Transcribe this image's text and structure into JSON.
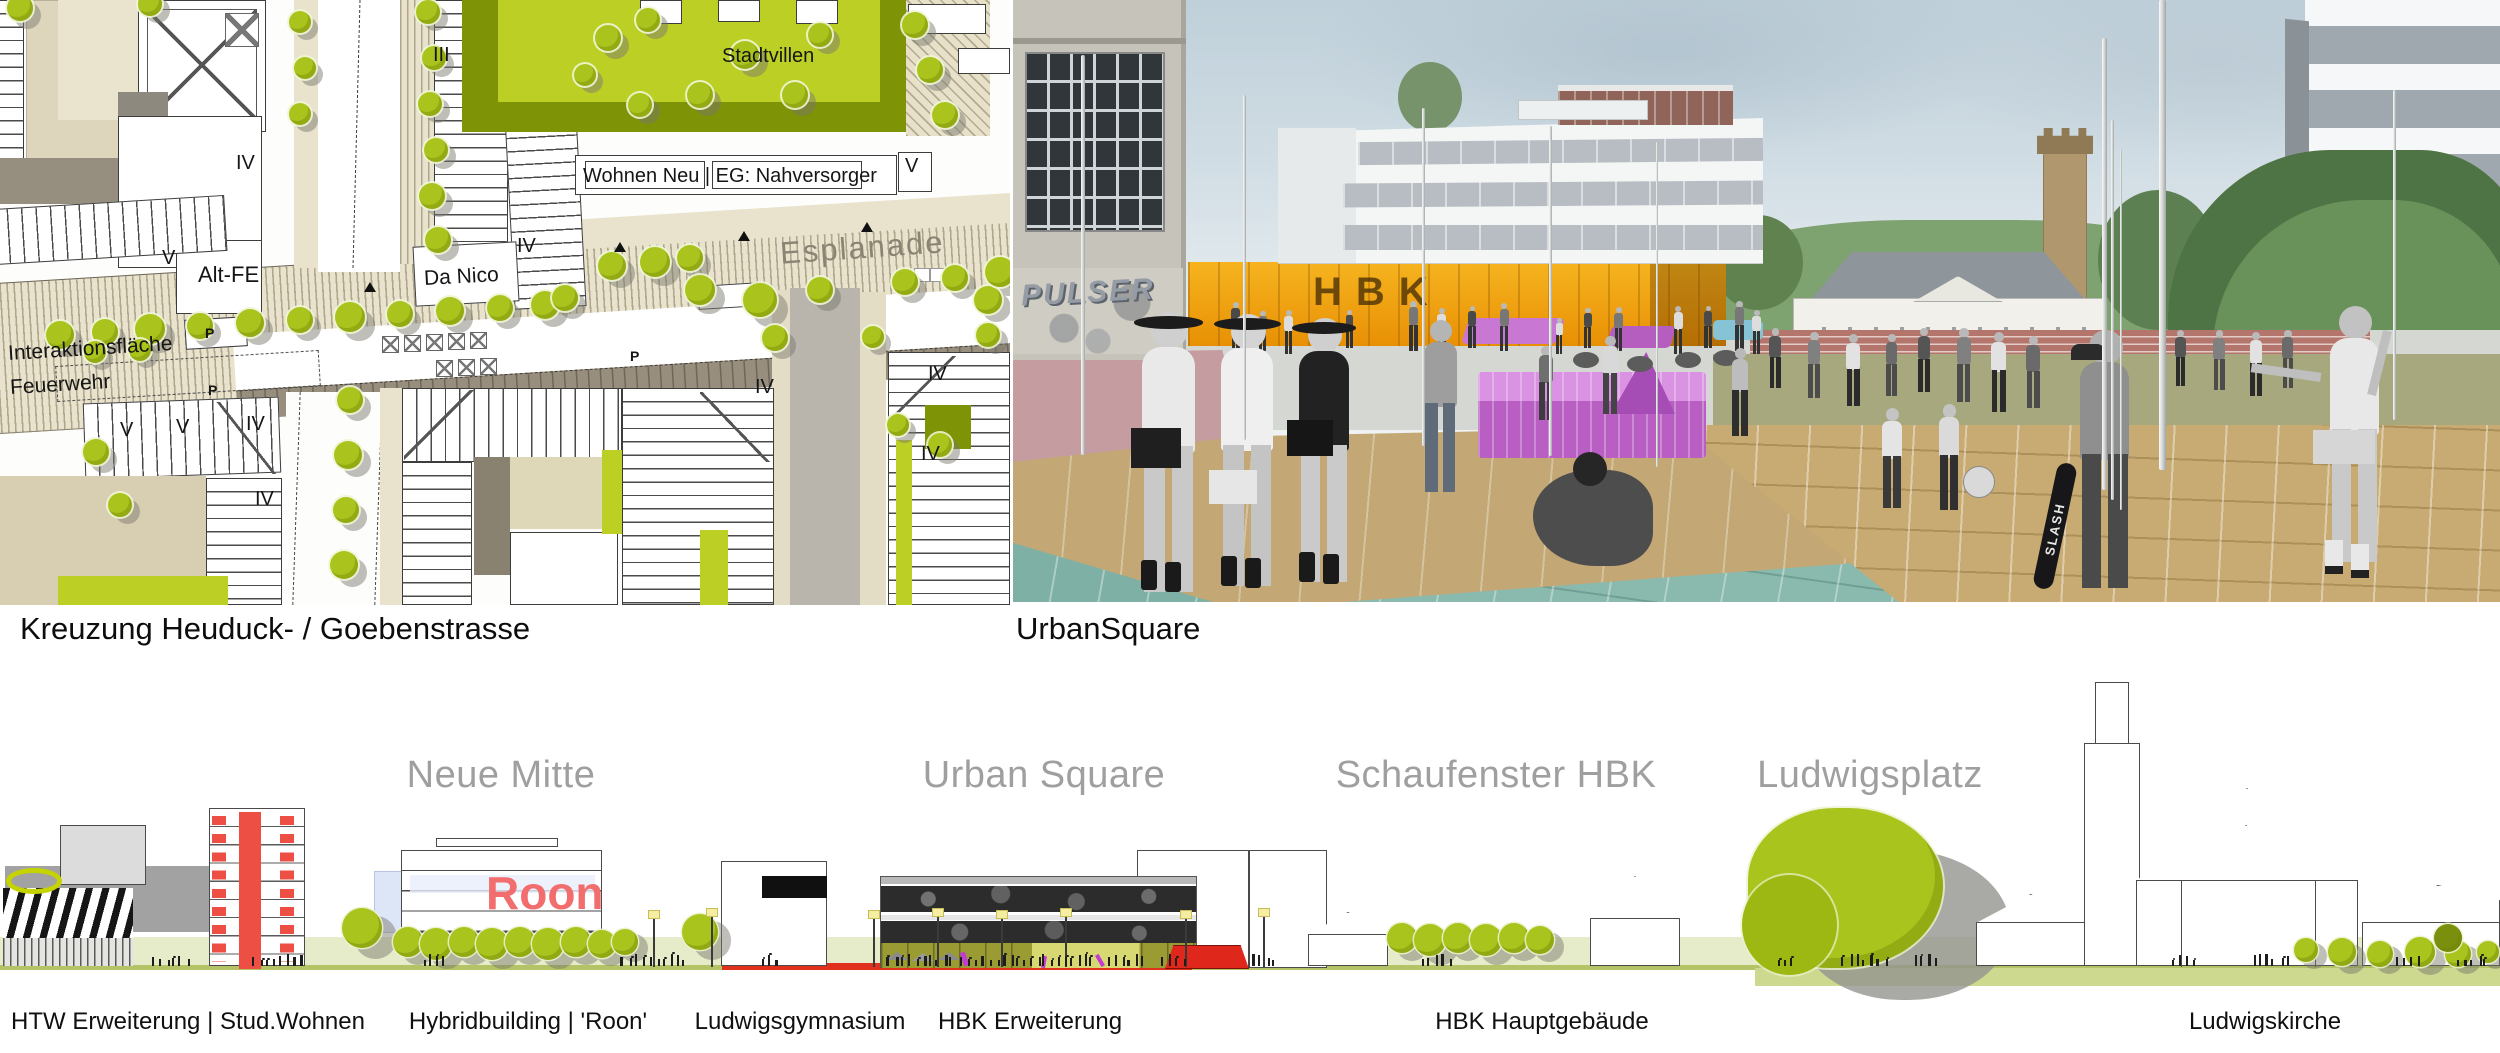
{
  "captions": {
    "map": "Kreuzung Heuduck- / Goebenstrasse",
    "render": "UrbanSquare"
  },
  "map": {
    "esplanade": "Esplanade",
    "stadtvillen": "Stadtvillen",
    "wohnen_neu": "Wohnen Neu | EG: Nahversorger",
    "da_nico": "Da Nico",
    "alt_fe": "Alt-FE",
    "interaktion_line1": "Interaktionsfläche",
    "interaktion_line2": "Feuerwehr",
    "parking_letter": "P",
    "storey_labels": [
      {
        "text": "III",
        "x": 433,
        "y": 45
      },
      {
        "text": "IV",
        "x": 236,
        "y": 153
      },
      {
        "text": "V",
        "x": 162,
        "y": 248
      },
      {
        "text": "IV",
        "x": 517,
        "y": 236
      },
      {
        "text": "V",
        "x": 905,
        "y": 156
      },
      {
        "text": "IV",
        "x": 755,
        "y": 377
      },
      {
        "text": "IV",
        "x": 928,
        "y": 364
      },
      {
        "text": "IV",
        "x": 921,
        "y": 444
      },
      {
        "text": "V",
        "x": 120,
        "y": 420
      },
      {
        "text": "V",
        "x": 176,
        "y": 417
      },
      {
        "text": "IV",
        "x": 246,
        "y": 414
      },
      {
        "text": "IV",
        "x": 255,
        "y": 489
      }
    ],
    "parking_positions": [
      {
        "x": 205,
        "y": 326
      },
      {
        "x": 208,
        "y": 383
      },
      {
        "x": 630,
        "y": 349
      }
    ],
    "marker_positions": [
      {
        "x": 364,
        "y": 282
      },
      {
        "x": 614,
        "y": 242
      },
      {
        "x": 738,
        "y": 231
      },
      {
        "x": 861,
        "y": 222
      }
    ]
  },
  "render": {
    "hbk_sign": "HBK",
    "graffiti": "PULSER",
    "skateboard_text": "SLASH"
  },
  "elevation": {
    "roon_sign": "Roon",
    "district_headings": [
      {
        "label": "Neue Mitte",
        "cx": 501
      },
      {
        "label": "Urban Square",
        "cx": 1044
      },
      {
        "label": "Schaufenster HBK",
        "cx": 1496
      },
      {
        "label": "Ludwigsplatz",
        "cx": 1870
      }
    ],
    "building_labels": [
      {
        "label": "HTW Erweiterung | Stud.Wohnen",
        "cx": 188
      },
      {
        "label": "Hybridbuilding | 'Roon'",
        "cx": 528
      },
      {
        "label": "Ludwigsgymnasium",
        "cx": 800
      },
      {
        "label": "HBK Erweiterung",
        "cx": 1030
      },
      {
        "label": "HBK Hauptgebäude",
        "cx": 1542
      },
      {
        "label": "Ludwigskirche",
        "cx": 2265
      }
    ]
  },
  "colors": {
    "tree_green": "#abc41d",
    "olive": "#7f9306",
    "bright_green": "#bccf25",
    "beige_band": "#e9e3cd",
    "taupe": "#978e7d",
    "tan_building": "#dcd5ba",
    "elevation_red": "#ee4f44",
    "roon_red": "#f26d6d",
    "kiosk_red": "#e0271c",
    "hbk_orange": "#f2a416",
    "plaza_teal": "#8ab9ae",
    "bench_magenta": "#c366cc",
    "ground_sage": "#e6ecc9",
    "heading_gray": "#9f9f9f"
  }
}
